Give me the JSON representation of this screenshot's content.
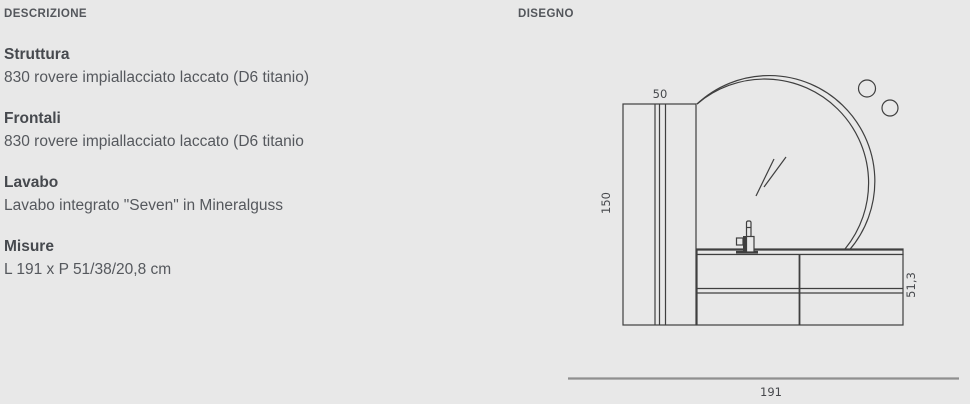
{
  "colors": {
    "background": "#e8e8e8",
    "drawing_line": "#3f3f3f",
    "dimension_line": "#8f8f8f",
    "header_text": "#53565b",
    "title_text": "#46494e",
    "body_text": "#55585d"
  },
  "description": {
    "header": "DESCRIZIONE",
    "sections": [
      {
        "title": "Struttura",
        "text": "830 rovere impiallacciato laccato (D6 titanio)"
      },
      {
        "title": "Frontali",
        "text": "830 rovere impiallacciato laccato (D6 titanio"
      },
      {
        "title": "Lavabo",
        "text": "Lavabo integrato \"Seven\" in Mineralguss"
      },
      {
        "title": "Misure",
        "text": "L 191 x P 51/38/20,8 cm"
      }
    ]
  },
  "drawing": {
    "header": "DISEGNO",
    "labels": {
      "cabinet_width": "50",
      "cabinet_height": "150",
      "vanity_depth": "51,3",
      "total_length": "191"
    }
  }
}
